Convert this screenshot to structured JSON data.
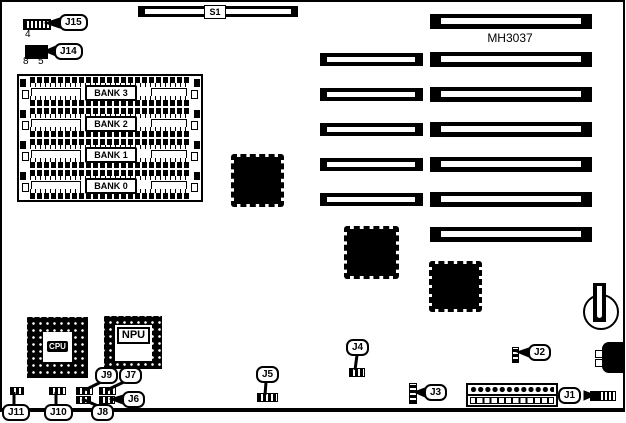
{
  "board_title": "MH3037",
  "colors": {
    "ink": "#000000",
    "background": "#ffffff"
  },
  "slots": {
    "s1_label": "S1",
    "left_column_count": 5,
    "right_column_count": 7
  },
  "memory": {
    "banks": [
      {
        "label": "BANK 3"
      },
      {
        "label": "BANK 2"
      },
      {
        "label": "BANK 1"
      },
      {
        "label": "BANK 0"
      }
    ]
  },
  "chips": {
    "cpu_label": "CPU",
    "npu_label": "NPU"
  },
  "jumpers": {
    "j14_pin_top": "4",
    "j14_pin_bottom_left": "8",
    "j14_pin_bottom_right": "5"
  },
  "callouts": {
    "j1": "J1",
    "j2": "J2",
    "j3": "J3",
    "j4": "J4",
    "j5": "J5",
    "j6": "J6",
    "j7": "J7",
    "j8": "J8",
    "j9": "J9",
    "j10": "J10",
    "j11": "J11",
    "j14": "J14",
    "j15": "J15"
  }
}
